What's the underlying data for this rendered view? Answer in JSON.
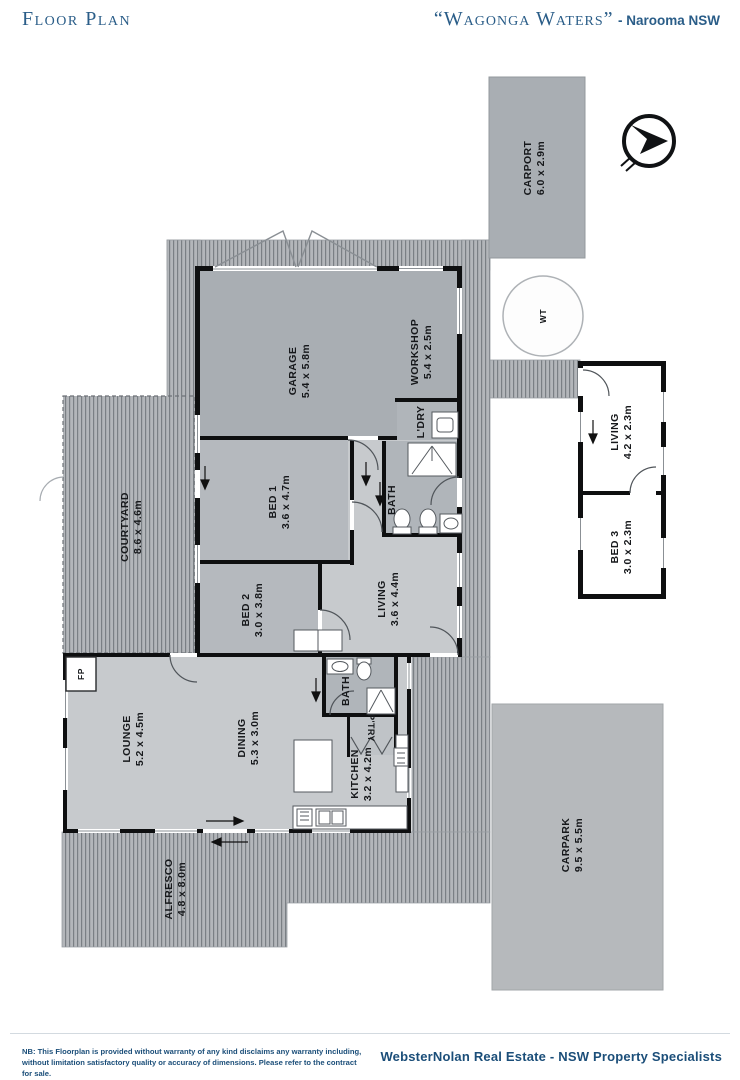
{
  "header": {
    "title": "Floor Plan",
    "property_name": "“Wagonga Waters”",
    "location_suffix": "- Narooma NSW"
  },
  "footer": {
    "disclaimer_line1": "NB: This Floorplan is provided without warranty of any kind disclaims any warranty including,",
    "disclaimer_line2": "without limitation satisfactory quality or accuracy of dimensions. Please refer to the contract for sale.",
    "agency": "WebsterNolan Real Estate - NSW Property Specialists"
  },
  "colors": {
    "header_blue": "#2a5d88",
    "footer_blue": "#1b4e79",
    "wall_black": "#0e0f10",
    "room_base_gray": "#c7cacd",
    "garage_gray": "#a9aeb3",
    "bed_gray": "#b5b9be",
    "bath_gray": "#b0b5ba",
    "deck_gray": "#b3b6ba",
    "carpark_gray": "#b6b9bc"
  },
  "rooms": {
    "carport": {
      "name": "CARPORT",
      "dims": "6.0 x 2.9m"
    },
    "garage": {
      "name": "GARAGE",
      "dims": "5.4 x 5.8m"
    },
    "workshop": {
      "name": "WORKSHOP",
      "dims": "5.4 x 2.5m"
    },
    "laundry": {
      "name": "L'DRY"
    },
    "bath1": {
      "name": "BATH"
    },
    "bed1": {
      "name": "BED 1",
      "dims": "3.6 x 4.7m"
    },
    "courtyard": {
      "name": "COURTYARD",
      "dims": "8.6 x 4.6m"
    },
    "bed2": {
      "name": "BED 2",
      "dims": "3.0 x 3.8m"
    },
    "living": {
      "name": "LIVING",
      "dims": "3.6 x 4.4m"
    },
    "lounge": {
      "name": "LOUNGE",
      "dims": "5.2 x 4.5m"
    },
    "dining": {
      "name": "DINING",
      "dims": "5.3 x 3.0m"
    },
    "kitchen": {
      "name": "KITCHEN",
      "dims": "3.2 x 4.2m"
    },
    "pantry": {
      "name": "P'TRY"
    },
    "bath2": {
      "name": "BATH"
    },
    "alfresco": {
      "name": "ALFRESCO",
      "dims": "4.8 x 8.0m"
    },
    "carpark": {
      "name": "CARPARK",
      "dims": "9.5 x 5.5m"
    },
    "living2": {
      "name": "LIVING",
      "dims": "4.2 x 2.3m"
    },
    "bed3": {
      "name": "BED 3",
      "dims": "3.0 x 2.3m"
    },
    "water_tank": {
      "name": "WT"
    },
    "fireplace": {
      "name": "FP"
    }
  }
}
